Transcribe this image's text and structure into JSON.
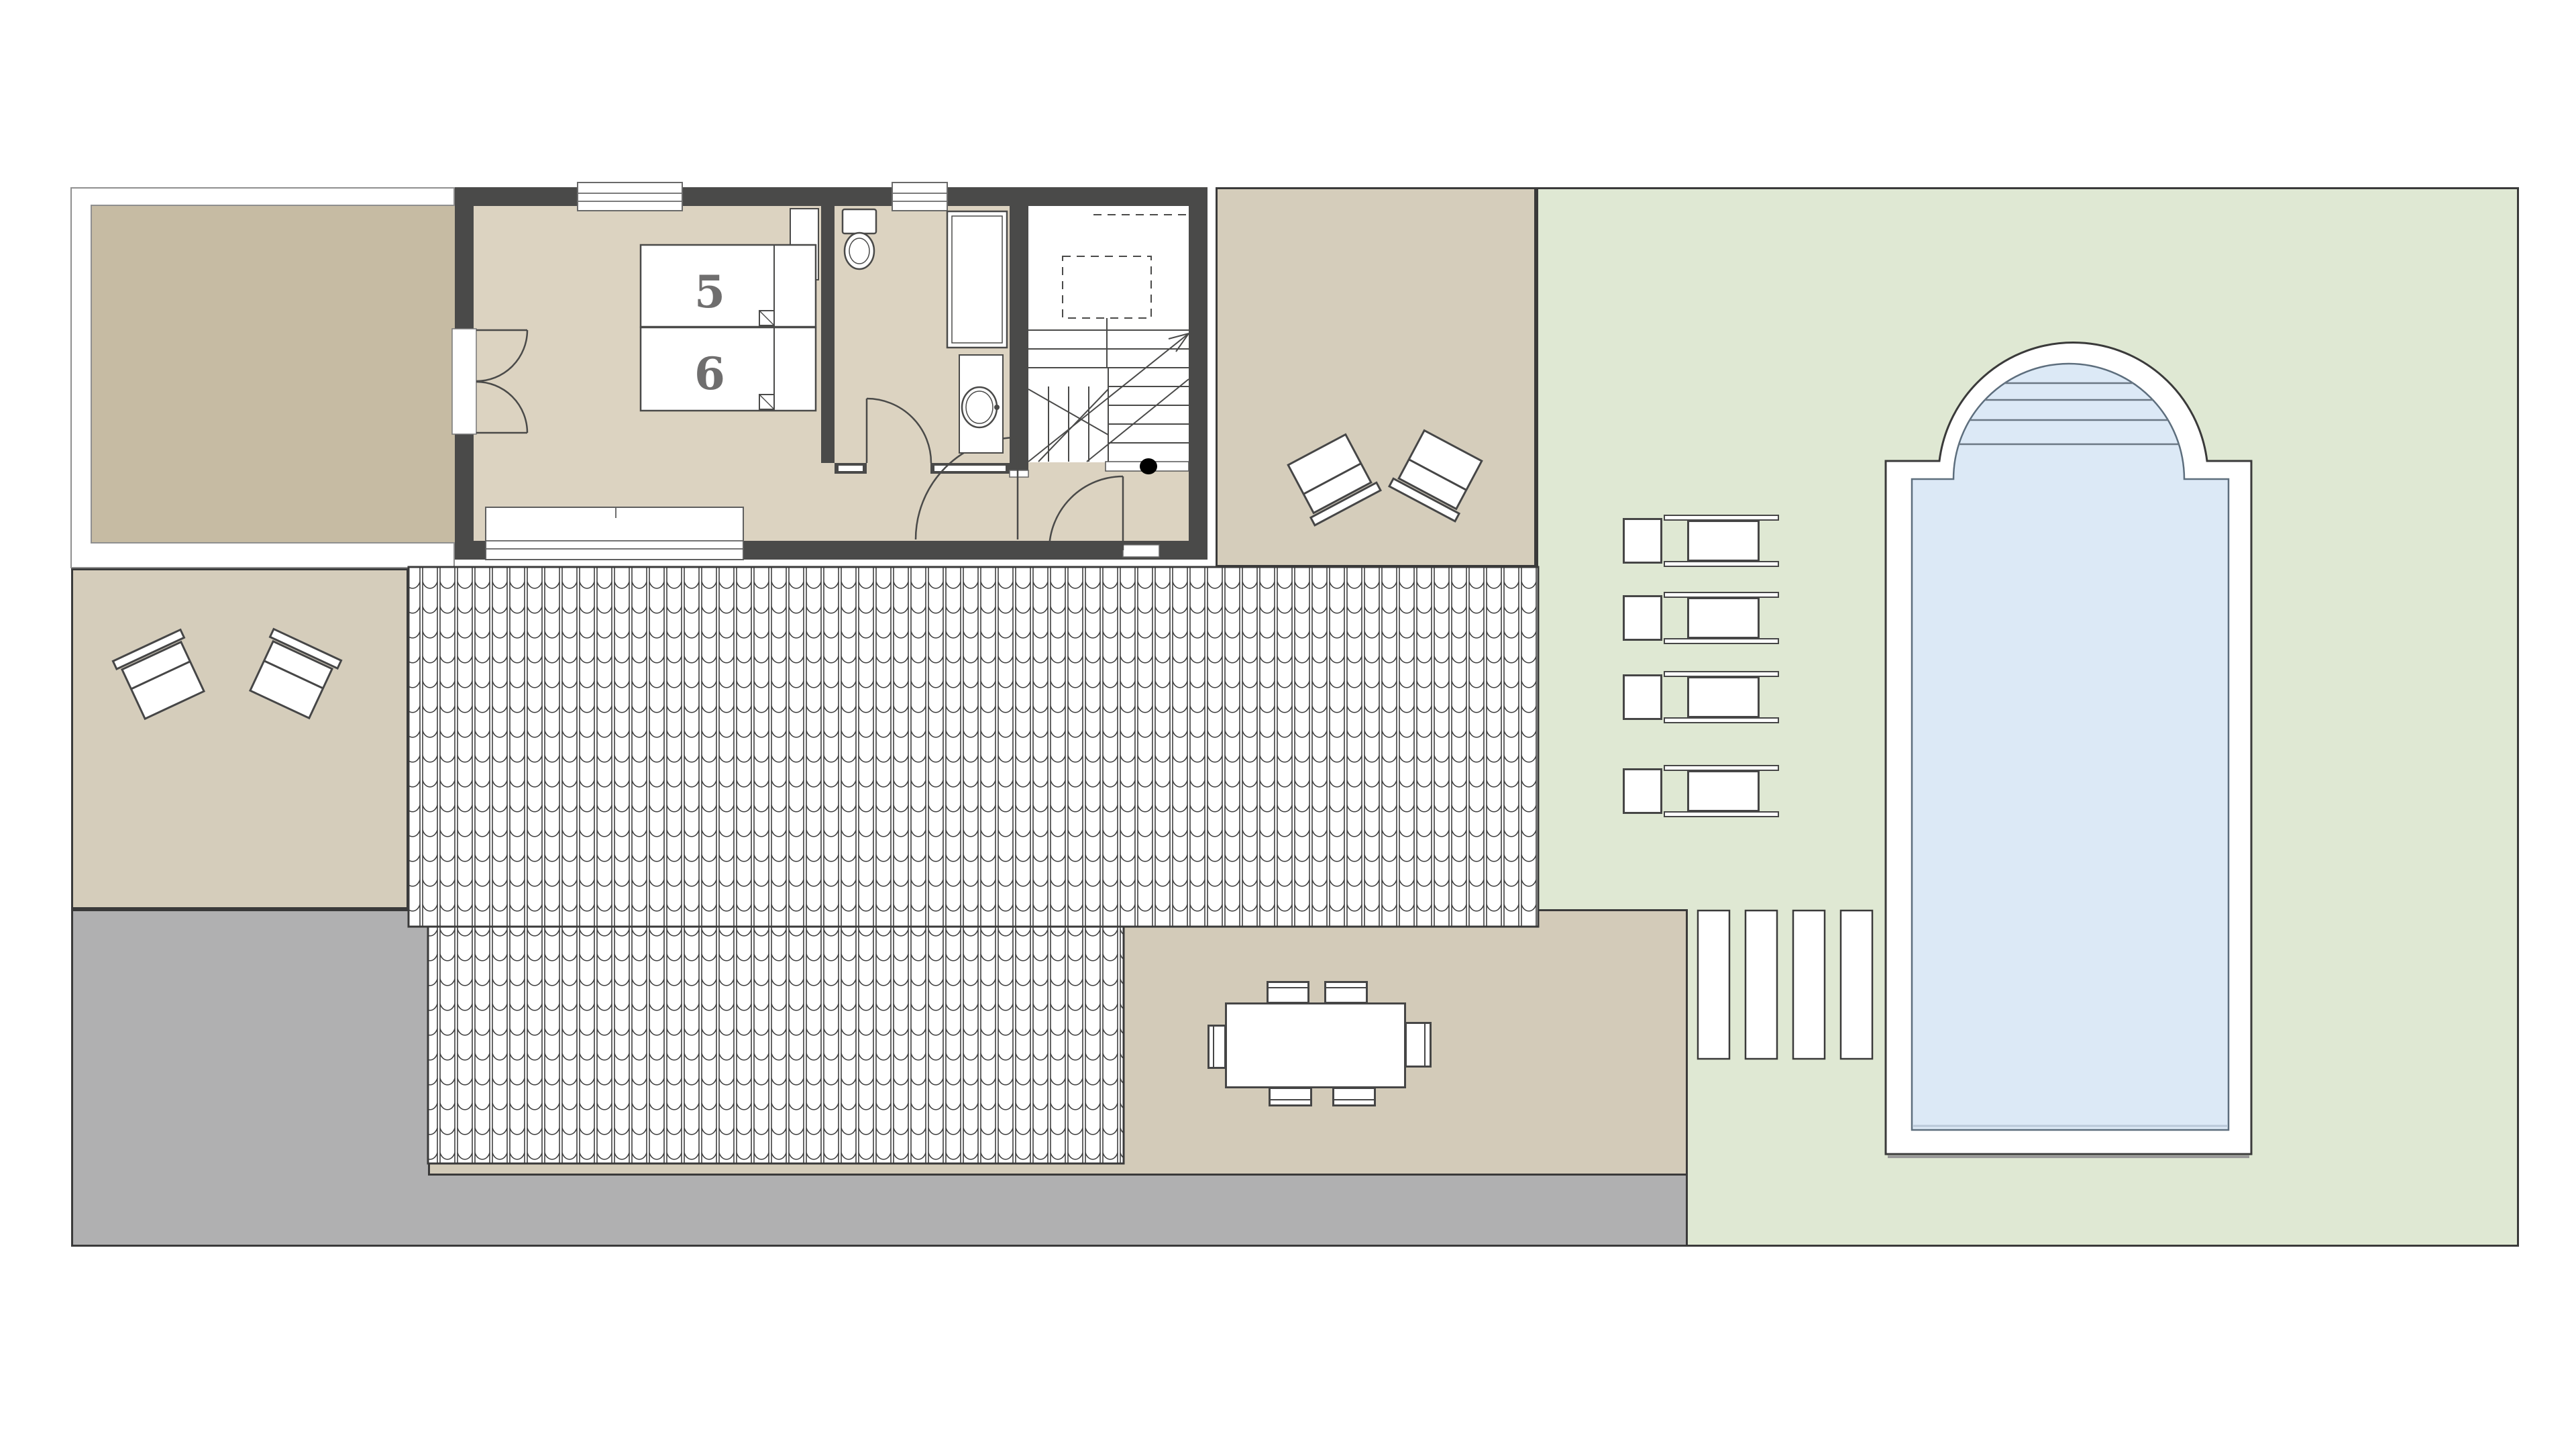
{
  "plan": {
    "name": "villa-floor-plan-with-garden-and-pool",
    "beds": [
      {
        "id": "bed-5",
        "label": "5"
      },
      {
        "id": "bed-6",
        "label": "6"
      }
    ],
    "colors": {
      "wall": "#4a4a49",
      "interior_floor": "#dcd3c1",
      "balcony_floor": "#c6bba3",
      "terrace_beige": "#d5cdbb",
      "dining_terrace": "#d3cbb9",
      "paving_gray": "#b0b0b1",
      "lawn_green": "#dfe8d3",
      "pool_water": "#dce9f6",
      "outline": "#3a3a3a",
      "bed_number": "#6f6e6e"
    }
  }
}
